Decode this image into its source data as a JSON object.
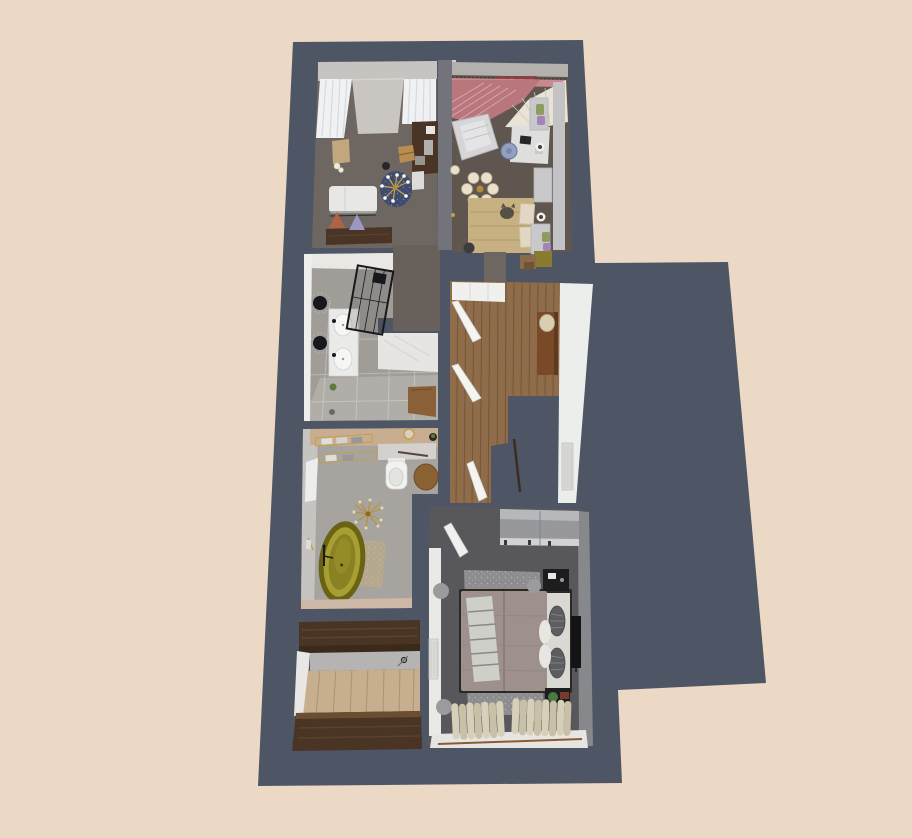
{
  "scene": {
    "type": "3d-floor-plan-top-view",
    "background_color": "#ebd9c5",
    "wall_color": "#4e5665"
  },
  "colors": {
    "background": "#ebd9c5",
    "wall": "#4e5665",
    "wall_divider": "#73737b",
    "living_floor": "#6e6660",
    "bedroom_pink_floor": "#5f574f",
    "canopy_pink": "#b9767c",
    "canopy_cream": "#e9e3d5",
    "bathroom_main_floor": "#a09d98",
    "marble": "#e9e8e4",
    "hallway_wood": "#8f6c4a",
    "bathroom_tub_floor": "#a7a4a0",
    "tub_gold": "#8a8122",
    "closet_wood": "#4a3424",
    "closet_floor": "#c7ae8e",
    "master_floor": "#58585c",
    "bed_duvet": "#9e908d",
    "rug_master": "#8d8d8f",
    "curtain_cream": "#d7d0b9",
    "gold": "#c2a04a",
    "white_furniture": "#e8e8e6",
    "dark_furniture": "#1d1d20",
    "console_brown": "#7a4a28"
  },
  "rooms": [
    {
      "id": "living-room",
      "furniture": [
        "window-curtains",
        "sofa-chaise",
        "floor-lamp",
        "sideboard",
        "triangle-cushions",
        "round-rug",
        "sputnik-chandelier",
        "desk",
        "desk-monitor",
        "wooden-chair",
        "side-table",
        "stool",
        "sculpture"
      ]
    },
    {
      "id": "bedroom-small",
      "furniture": [
        "canopy-drape",
        "floral-garland",
        "glam-armchair",
        "shade-chandelier",
        "pendant-lamp",
        "bed",
        "cat",
        "desk",
        "office-chair",
        "wall-shelves",
        "plants",
        "dresser",
        "boxes"
      ]
    },
    {
      "id": "bathroom-main",
      "furniture": [
        "double-vanity",
        "sinks",
        "round-mirrors",
        "walk-in-shower",
        "shower-head",
        "plant",
        "wooden-door",
        "floor-drain"
      ]
    },
    {
      "id": "hallway",
      "furniture": [
        "closet-doors",
        "door-leaf",
        "console-table",
        "vase",
        "radiator",
        "floor-lamp-pole"
      ]
    },
    {
      "id": "bathroom-tub",
      "furniture": [
        "freestanding-bathtub",
        "floor-faucet",
        "sputnik-chandelier",
        "bath-mat",
        "towel-shelves",
        "towel-bar",
        "toilet",
        "round-stool",
        "vanity-counter",
        "wall-mirror",
        "plant"
      ]
    },
    {
      "id": "walk-in-closet",
      "furniture": [
        "wardrobe-top",
        "wardrobe-bottom",
        "door-handle"
      ]
    },
    {
      "id": "bedroom-master",
      "furniture": [
        "sliding-wardrobe",
        "double-bed",
        "dark-pillows",
        "white-pillows",
        "throw-blanket",
        "area-rug",
        "nightstand-top",
        "nightstand-bottom",
        "tv",
        "window-curtains",
        "curtain-rod",
        "radiator",
        "poufs",
        "interior-door"
      ]
    }
  ]
}
